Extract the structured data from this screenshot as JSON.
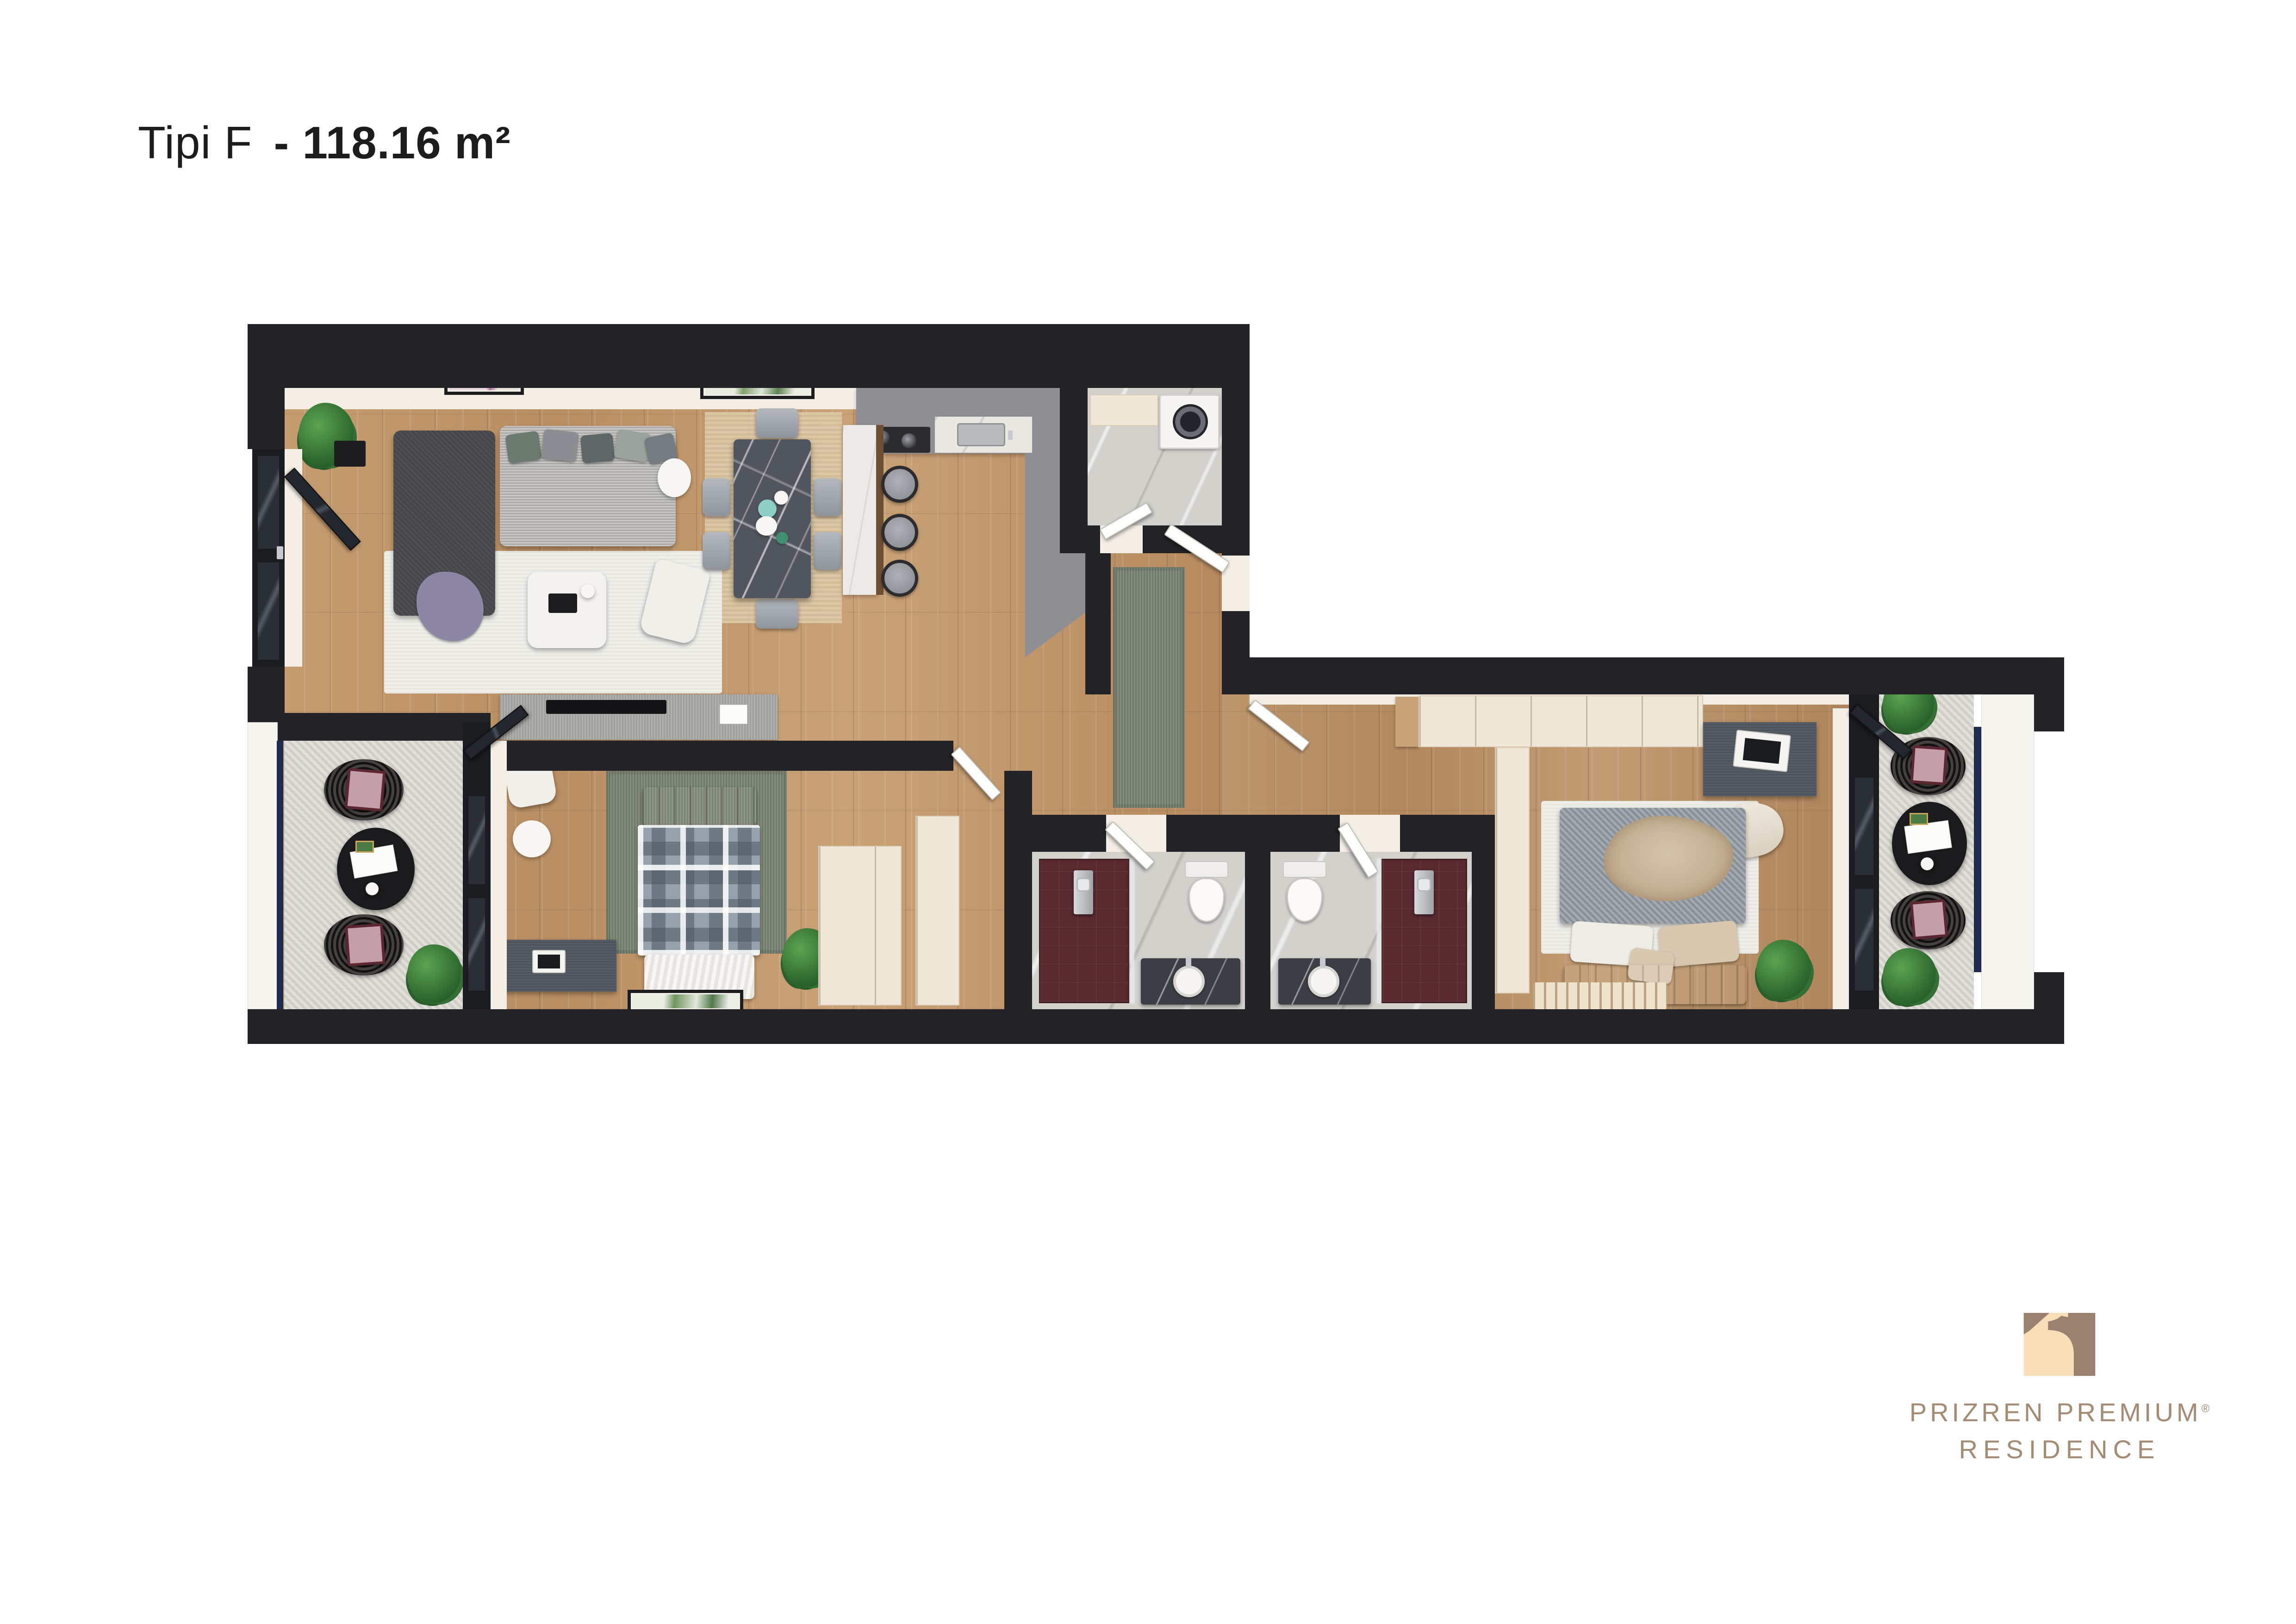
{
  "title": {
    "prefix": "Tipi F",
    "rest": "- 118.16 m²"
  },
  "logo": {
    "line1": "PRIZREN PREMIUM",
    "registered": "®",
    "line2": "RESIDENCE"
  },
  "theme": {
    "title": "#1c1c1e",
    "brand": "#a48b74",
    "logo-cream": "#f8dfb8",
    "logo-brown": "#9b8270",
    "wall": "#232327",
    "wood": "#bf9468",
    "stone": "#d8d5cd",
    "marble": "#d3d1cb",
    "ruggreen": "#7e8877",
    "ruglight": "#efeee8",
    "maroon": "#58292e",
    "counter": "#8f8f93",
    "cream": "#f0e7d8",
    "navy": "#1e2b4e",
    "plant": "#2e6b2f"
  }
}
